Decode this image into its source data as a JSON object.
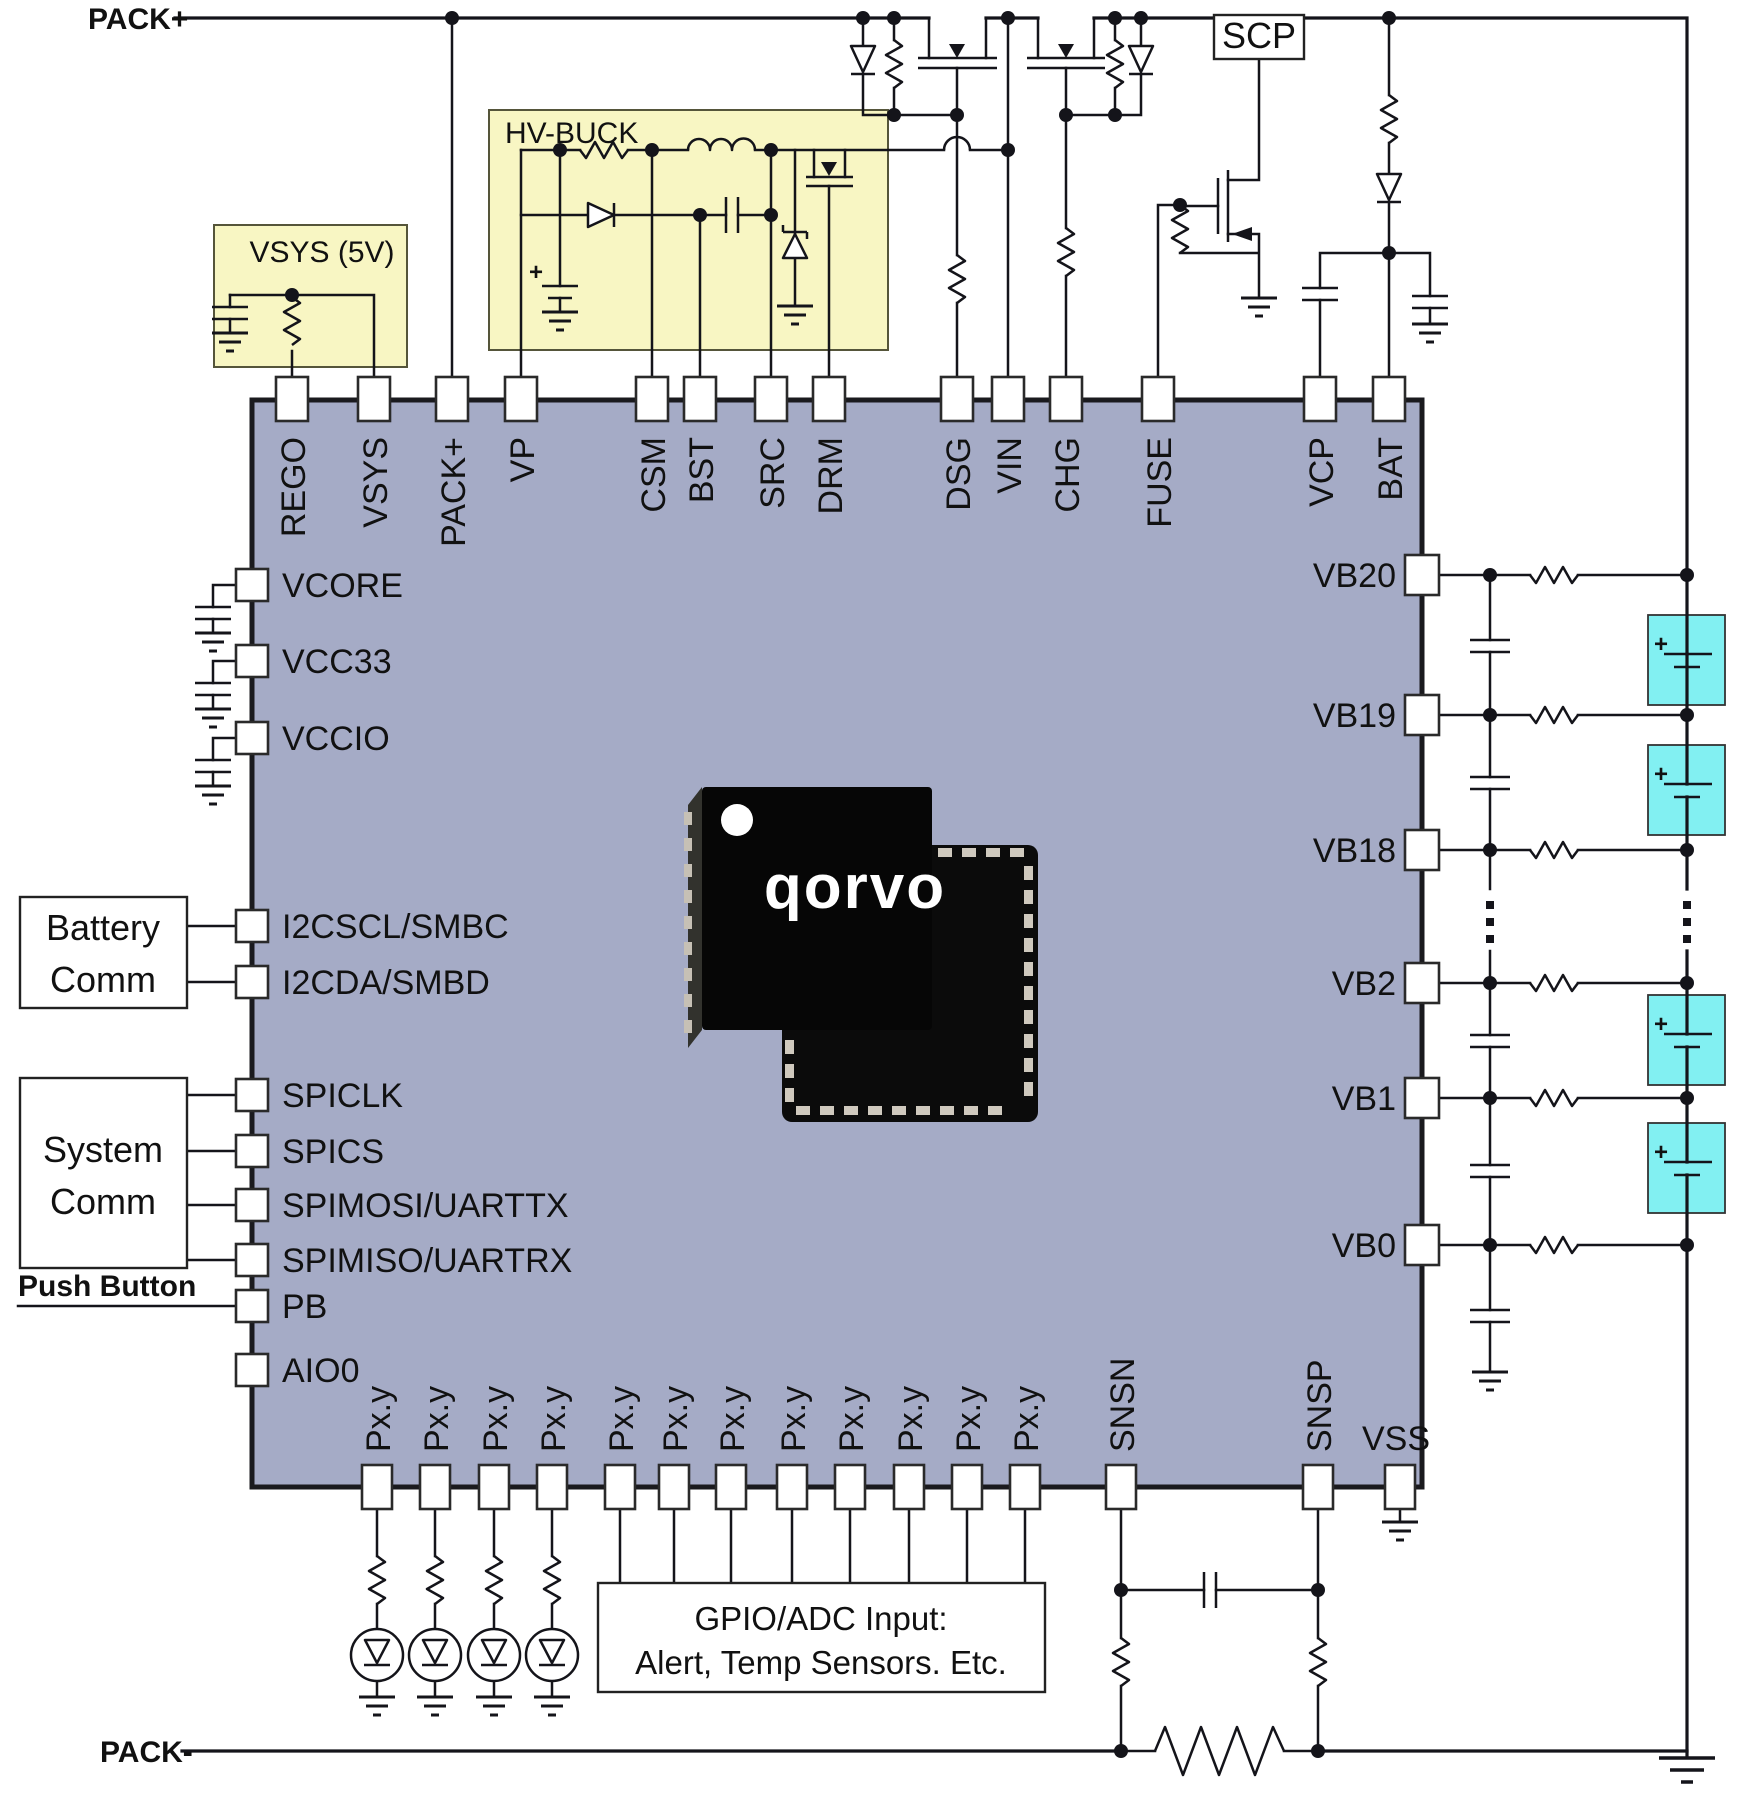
{
  "diagram_title": "Qorvo battery management IC application schematic",
  "nets": {
    "pack_plus": "PACK+",
    "pack_minus": "PACK-"
  },
  "modules": {
    "vsys": {
      "title": "VSYS (5V)"
    },
    "hv_buck": {
      "title": "HV-BUCK"
    },
    "scp": {
      "label": "SCP"
    },
    "battery_comm": {
      "line1": "Battery",
      "line2": "Comm"
    },
    "system_comm": {
      "line1": "System",
      "line2": "Comm"
    },
    "push_button": {
      "label": "Push Button"
    },
    "gpio_box": {
      "line1": "GPIO/ADC Input:",
      "line2": "Alert, Temp Sensors. Etc."
    }
  },
  "pins": {
    "top": [
      {
        "label": "REGO"
      },
      {
        "label": "VSYS"
      },
      {
        "label": "PACK+"
      },
      {
        "label": "VP"
      },
      {
        "label": "CSM"
      },
      {
        "label": "BST"
      },
      {
        "label": "SRC"
      },
      {
        "label": "DRM"
      },
      {
        "label": "DSG"
      },
      {
        "label": "VIN"
      },
      {
        "label": "CHG"
      },
      {
        "label": "FUSE"
      },
      {
        "label": "VCP"
      },
      {
        "label": "BAT"
      }
    ],
    "left": [
      {
        "label": "VCORE"
      },
      {
        "label": "VCC33"
      },
      {
        "label": "VCCIO"
      },
      {
        "label": "I2CSCL/SMBC"
      },
      {
        "label": "I2CDA/SMBD"
      },
      {
        "label": "SPICLK"
      },
      {
        "label": "SPICS"
      },
      {
        "label": "SPIMOSI/UARTTX"
      },
      {
        "label": "SPIMISO/UARTRX"
      },
      {
        "label": "PB"
      },
      {
        "label": "AIO0"
      }
    ],
    "right": [
      {
        "label": "VB20"
      },
      {
        "label": "VB19"
      },
      {
        "label": "VB18"
      },
      {
        "label": "VB2"
      },
      {
        "label": "VB1"
      },
      {
        "label": "VB0"
      }
    ],
    "bottom": [
      {
        "label": "Px.y"
      },
      {
        "label": "Px.y"
      },
      {
        "label": "Px.y"
      },
      {
        "label": "Px.y"
      },
      {
        "label": "Px.y"
      },
      {
        "label": "Px.y"
      },
      {
        "label": "Px.y"
      },
      {
        "label": "Px.y"
      },
      {
        "label": "Px.y"
      },
      {
        "label": "Px.y"
      },
      {
        "label": "Px.y"
      },
      {
        "label": "Px.y"
      },
      {
        "label": "SNSN"
      },
      {
        "label": "SNSP"
      }
    ],
    "vss": "VSS"
  },
  "logo": {
    "brand": "Qorvo"
  },
  "symbols": {
    "plus": "+"
  },
  "colors": {
    "chip_fill": "#a5abc6",
    "module_fill": "#f8f6c3",
    "cell_fill": "#82f0f2",
    "wire": "#14141a",
    "package_black": "#0b0b0b"
  }
}
